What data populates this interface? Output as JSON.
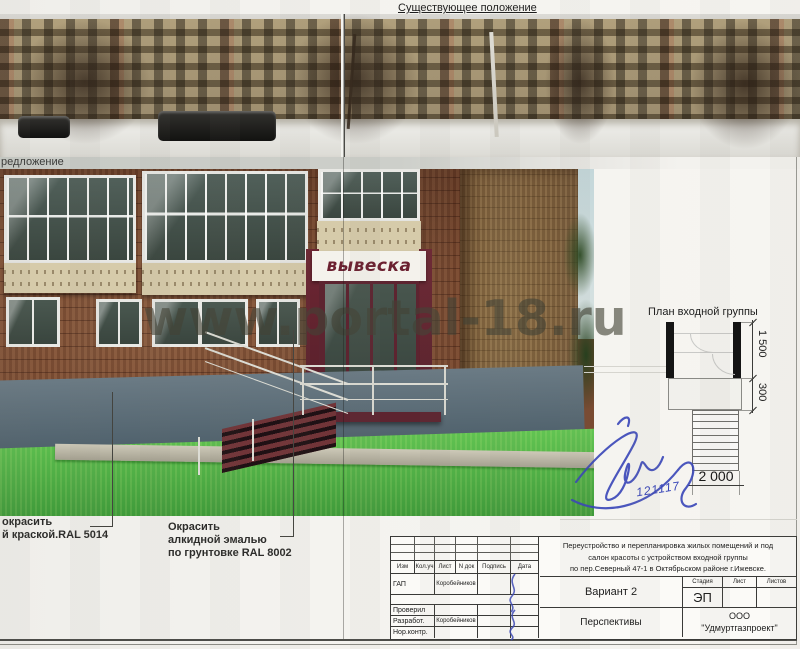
{
  "header": {
    "existing_title": "Существующее положение",
    "proposal_label": "редложение"
  },
  "watermark": "www.portal-18.ru",
  "render": {
    "sign": "вывеска"
  },
  "plan": {
    "title": "План входной группы",
    "dims": {
      "v1": "1 500",
      "v2": "300",
      "h": "2 000"
    }
  },
  "signature_date": "121117",
  "notes": {
    "note1": {
      "line1": "окрасить",
      "line2": "й краской.RAL 5014"
    },
    "note2": {
      "line1": "Окрасить",
      "line2": "алкидной  эмалью",
      "line3": "по грунтовке RAL 8002"
    }
  },
  "titleblock": {
    "project_line1": "Переустройство и перепланировка жилых помещений и  под",
    "project_line2": "салон красоты с устройством входной группы",
    "project_line3": "по пер.Северный  47-1   в Октябрьском районе   г.Ижевске.",
    "variant": "Вариант 2",
    "view": "Перспективы",
    "stage_label": "Стадия",
    "sheet_label": "Лист",
    "sheets_label": "Листов",
    "stage": "ЭП",
    "company_line1": "ООО",
    "company_line2": "\"Удмуртгазпроект\"",
    "columns": [
      "Изм",
      "Кол.уч",
      "Лист",
      "N док",
      "Подпись",
      "Дата"
    ],
    "rows": [
      {
        "role": "ГАП",
        "name": "Коробейников"
      },
      {
        "role": "Проверил",
        "name": ""
      },
      {
        "role": "Разработ.",
        "name": "Коробейников"
      },
      {
        "role": "Нор.контр.",
        "name": ""
      }
    ]
  },
  "colors": {
    "brick": "#794a31",
    "plinth_ral5014": "#5c6d79",
    "lawn": "#57b84a",
    "sign_text": "#6b2030",
    "entrance_ral8002": "#5d2430",
    "ink": "#3946b8"
  }
}
